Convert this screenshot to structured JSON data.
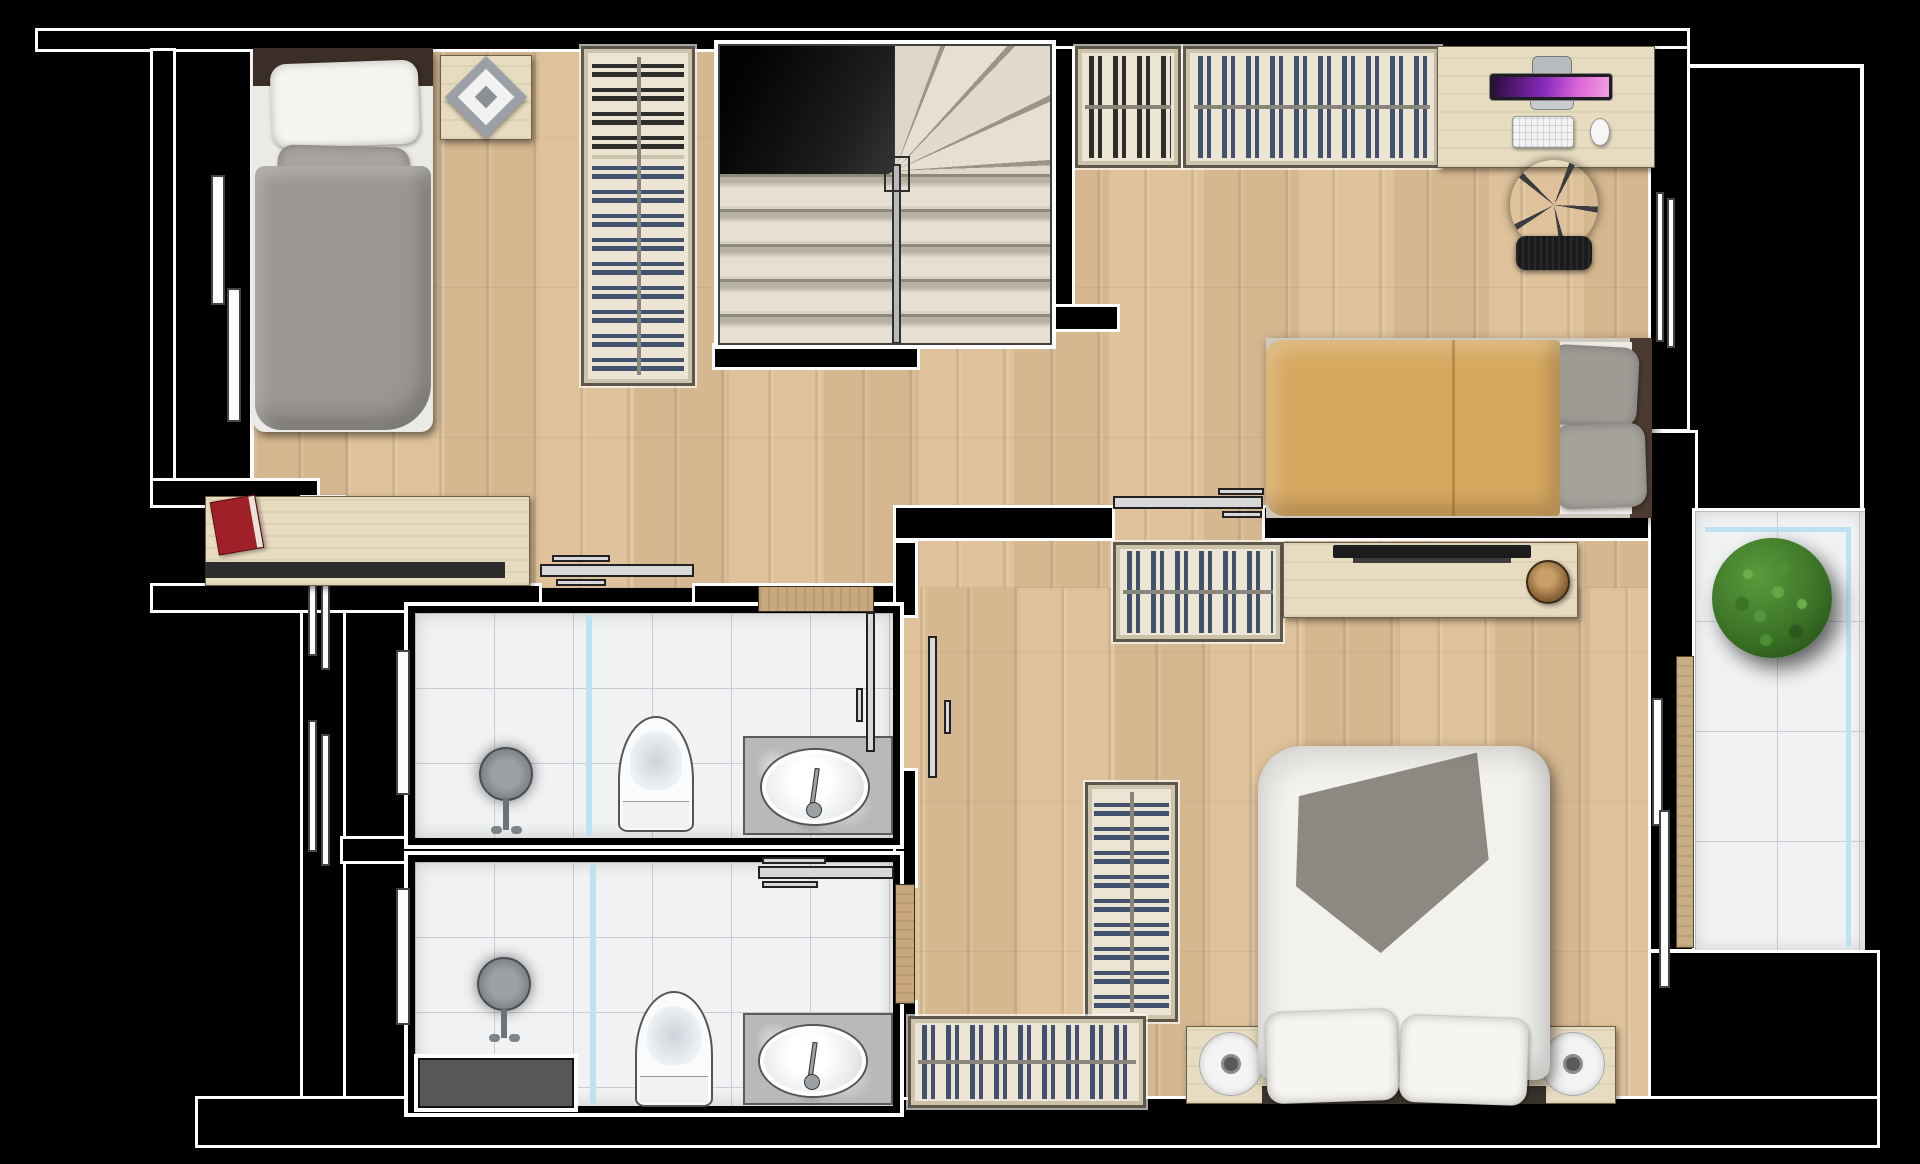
{
  "title": "Apartment upper-floor plan (top-down architectural rendering)",
  "palette": {
    "bg": "#000000",
    "outline": "#ffffff",
    "wood": "#dfc29b",
    "tile": "#f1f2f3",
    "tile-grid": "#c9cdd1",
    "glass": "#bfe2f0",
    "closet-bg": "#ece5d3",
    "clothes-blue": "#41516e",
    "clothes-dark": "#2f2d29",
    "stair-light": "#e5dfd2",
    "duvet-gray": "#9a9792",
    "duvet-orange": "#d7a860",
    "duvet-white": "#f2f1ee",
    "throw": "#8c8981",
    "headboard": "#3a2e26",
    "furn-wood": "#e8dcc0",
    "marble": "#b7bab6",
    "plant": "#3c7427",
    "bowl": "#9c7347",
    "book": "#a02028",
    "door-metal": "#d8d8d8",
    "door-wood": "#c8a87c",
    "screen-gradient": "#2b0b3a,#8a2bbf,#e06ad8,#f0a0e0"
  },
  "rooms": [
    {
      "name": "bedroom-1",
      "position": "top-left",
      "furniture": [
        "single-bed-gray",
        "nightstand-with-diamond-decor",
        "wardrobe-dark-and-blue-clothes",
        "desk-with-red-book",
        "window-left"
      ]
    },
    {
      "name": "staircase",
      "position": "top-center",
      "furniture": [
        "winder-stairs",
        "handrail"
      ]
    },
    {
      "name": "bedroom-2",
      "position": "top-right",
      "furniture": [
        "closet-dark-clothes",
        "closet-blue-clothes",
        "computer-desk",
        "imac-monitor",
        "keyboard",
        "mouse",
        "office-chair",
        "double-bed-orange",
        "sliding-door",
        "window-right"
      ]
    },
    {
      "name": "hallway",
      "position": "center",
      "furniture": [
        "pocket-door-leaves"
      ]
    },
    {
      "name": "bathroom-1",
      "position": "middle-left",
      "furniture": [
        "shower-head",
        "glass-partition",
        "toilet",
        "marble-vanity-sink",
        "sliding-door",
        "window"
      ]
    },
    {
      "name": "bathroom-2",
      "position": "bottom-left",
      "furniture": [
        "shower-head",
        "glass-partition",
        "toilet",
        "marble-vanity-sink",
        "sliding-door",
        "window",
        "gray-mat"
      ]
    },
    {
      "name": "master-bedroom",
      "position": "bottom-right",
      "furniture": [
        "closet-blue-clothes",
        "tv-dresser",
        "decor-bowl",
        "tall-closet",
        "low-closet",
        "double-bed-white-with-gray-throw",
        "nightstand-left-with-disc",
        "nightstand-right-with-disc",
        "windows-right"
      ]
    },
    {
      "name": "balcony",
      "position": "right",
      "furniture": [
        "round-green-plant",
        "glass-railing-line",
        "tile-floor"
      ]
    }
  ]
}
